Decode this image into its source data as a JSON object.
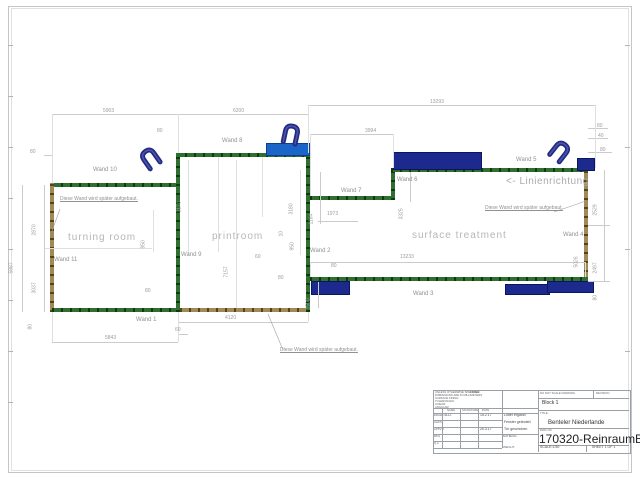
{
  "drawing": {
    "rooms": [
      {
        "label": "turning room",
        "x": 68,
        "y": 232
      },
      {
        "label": "printroom",
        "x": 212,
        "y": 231
      },
      {
        "label": "surface treatment",
        "x": 412,
        "y": 230
      }
    ],
    "wall_labels": [
      {
        "label": "Wand 1",
        "x": 136,
        "y": 317
      },
      {
        "label": "Wand 2",
        "x": 310,
        "y": 248
      },
      {
        "label": "Wand 3",
        "x": 413,
        "y": 291
      },
      {
        "label": "Wand 4",
        "x": 563,
        "y": 232
      },
      {
        "label": "Wand 5",
        "x": 516,
        "y": 157
      },
      {
        "label": "Wand 6",
        "x": 397,
        "y": 177
      },
      {
        "label": "Wand 7",
        "x": 341,
        "y": 188
      },
      {
        "label": "Wand 8",
        "x": 222,
        "y": 138
      },
      {
        "label": "Wand 9",
        "x": 181,
        "y": 252
      },
      {
        "label": "Wand 10",
        "x": 93,
        "y": 167
      },
      {
        "label": "Wand 11",
        "x": 54,
        "y": 257
      }
    ],
    "dimensions": [
      {
        "v": "5903",
        "x": 103,
        "y": 109
      },
      {
        "v": "6200",
        "x": 233,
        "y": 109
      },
      {
        "v": "13293",
        "x": 430,
        "y": 100
      },
      {
        "v": "3994",
        "x": 365,
        "y": 129
      },
      {
        "v": "80",
        "x": 157,
        "y": 129
      },
      {
        "v": "80",
        "x": 30,
        "y": 150
      },
      {
        "v": "80",
        "x": 597,
        "y": 124
      },
      {
        "v": "40",
        "x": 598,
        "y": 134
      },
      {
        "v": "80",
        "x": 600,
        "y": 148
      },
      {
        "v": "5987",
        "x": 15,
        "y": 268,
        "r": 1
      },
      {
        "v": "2870",
        "x": 38,
        "y": 230,
        "r": 1
      },
      {
        "v": "3037",
        "x": 38,
        "y": 288,
        "r": 1
      },
      {
        "v": "80",
        "x": 34,
        "y": 324,
        "r": 1
      },
      {
        "v": "3170",
        "x": 183,
        "y": 207,
        "r": 1
      },
      {
        "v": "3180",
        "x": 295,
        "y": 209,
        "r": 1
      },
      {
        "v": "7157",
        "x": 230,
        "y": 272,
        "r": 1
      },
      {
        "v": "950",
        "x": 147,
        "y": 243,
        "r": 1
      },
      {
        "v": "950",
        "x": 296,
        "y": 245,
        "r": 1
      },
      {
        "v": "10",
        "x": 285,
        "y": 231,
        "r": 1
      },
      {
        "v": "1164",
        "x": 315,
        "y": 219,
        "r": 1
      },
      {
        "v": "1973",
        "x": 327,
        "y": 212
      },
      {
        "v": "3325",
        "x": 405,
        "y": 214,
        "r": 1
      },
      {
        "v": "60",
        "x": 255,
        "y": 255
      },
      {
        "v": "80",
        "x": 331,
        "y": 264
      },
      {
        "v": "1500",
        "x": 312,
        "y": 304,
        "r": 1
      },
      {
        "v": "13233",
        "x": 400,
        "y": 255
      },
      {
        "v": "80",
        "x": 278,
        "y": 276
      },
      {
        "v": "5843",
        "x": 105,
        "y": 336
      },
      {
        "v": "4120",
        "x": 225,
        "y": 316
      },
      {
        "v": "60",
        "x": 175,
        "y": 328
      },
      {
        "v": "80",
        "x": 145,
        "y": 289
      },
      {
        "v": "2529",
        "x": 599,
        "y": 210,
        "r": 1
      },
      {
        "v": "2497",
        "x": 599,
        "y": 268,
        "r": 1
      },
      {
        "v": "5026",
        "x": 580,
        "y": 262,
        "r": 1
      },
      {
        "v": "80",
        "x": 599,
        "y": 295,
        "r": 1
      }
    ],
    "annotations": [
      {
        "text": "Diese Wand wird später aufgebaut.",
        "x": 60,
        "y": 197,
        "u": 1
      },
      {
        "text": "Diese Wand wird später aufgebaut.",
        "x": 485,
        "y": 206,
        "u": 1
      },
      {
        "text": "Diese Wand wird später aufgebaut.",
        "x": 280,
        "y": 348,
        "u": 1
      },
      {
        "text": "<- Linienrichtung",
        "x": 506,
        "y": 176,
        "dir": 1
      }
    ],
    "colors": {
      "wall_green": "#2f6f30",
      "wall_later_brown": "#a08b57",
      "fan_blue": "#1b2a8c",
      "fan_bright_blue": "#1b64c8"
    }
  },
  "titleblock": {
    "spec_note": [
      "UNLESS OTHERWISE SPECIFIED:",
      "DIMENSIONS ARE IN MILLIMETERS",
      "SURFACE FINISH:",
      "TOLERANCES:",
      "   LINEAR:",
      "   ANGULAR:"
    ],
    "finish_label": "FINISH:",
    "do_not_scale": "DO NOT SCALE DRAWING",
    "revision_label": "REVISION",
    "revision_value": "Block 1",
    "cols": [
      "NAME",
      "SIGNATURE",
      "DATE"
    ],
    "rows": [
      {
        "role": "DRAWN",
        "name": "A.D.",
        "date": "15.2.17",
        "note": "Lüfter ergänzt"
      },
      {
        "role": "CHK'D",
        "name": "",
        "date": "",
        "note": "Fenster geändert"
      },
      {
        "role": "APPV'D",
        "name": "",
        "date": "20.3.17",
        "note": "Tür geschoben"
      },
      {
        "role": "MFG",
        "name": "",
        "date": "",
        "note": ""
      },
      {
        "role": "Q.A",
        "name": "",
        "date": "",
        "note": ""
      }
    ],
    "title_label": "TITLE:",
    "title": "Benteler Niederlande",
    "material_label": "MATERIAL:",
    "weight_label": "WEIGHT:",
    "dwg_label": "DWG NO.",
    "drawing_number": "170320-ReinraumBG-f",
    "scale": "SCALE:1:50",
    "sheet": "SHEET 1 OF 1"
  }
}
